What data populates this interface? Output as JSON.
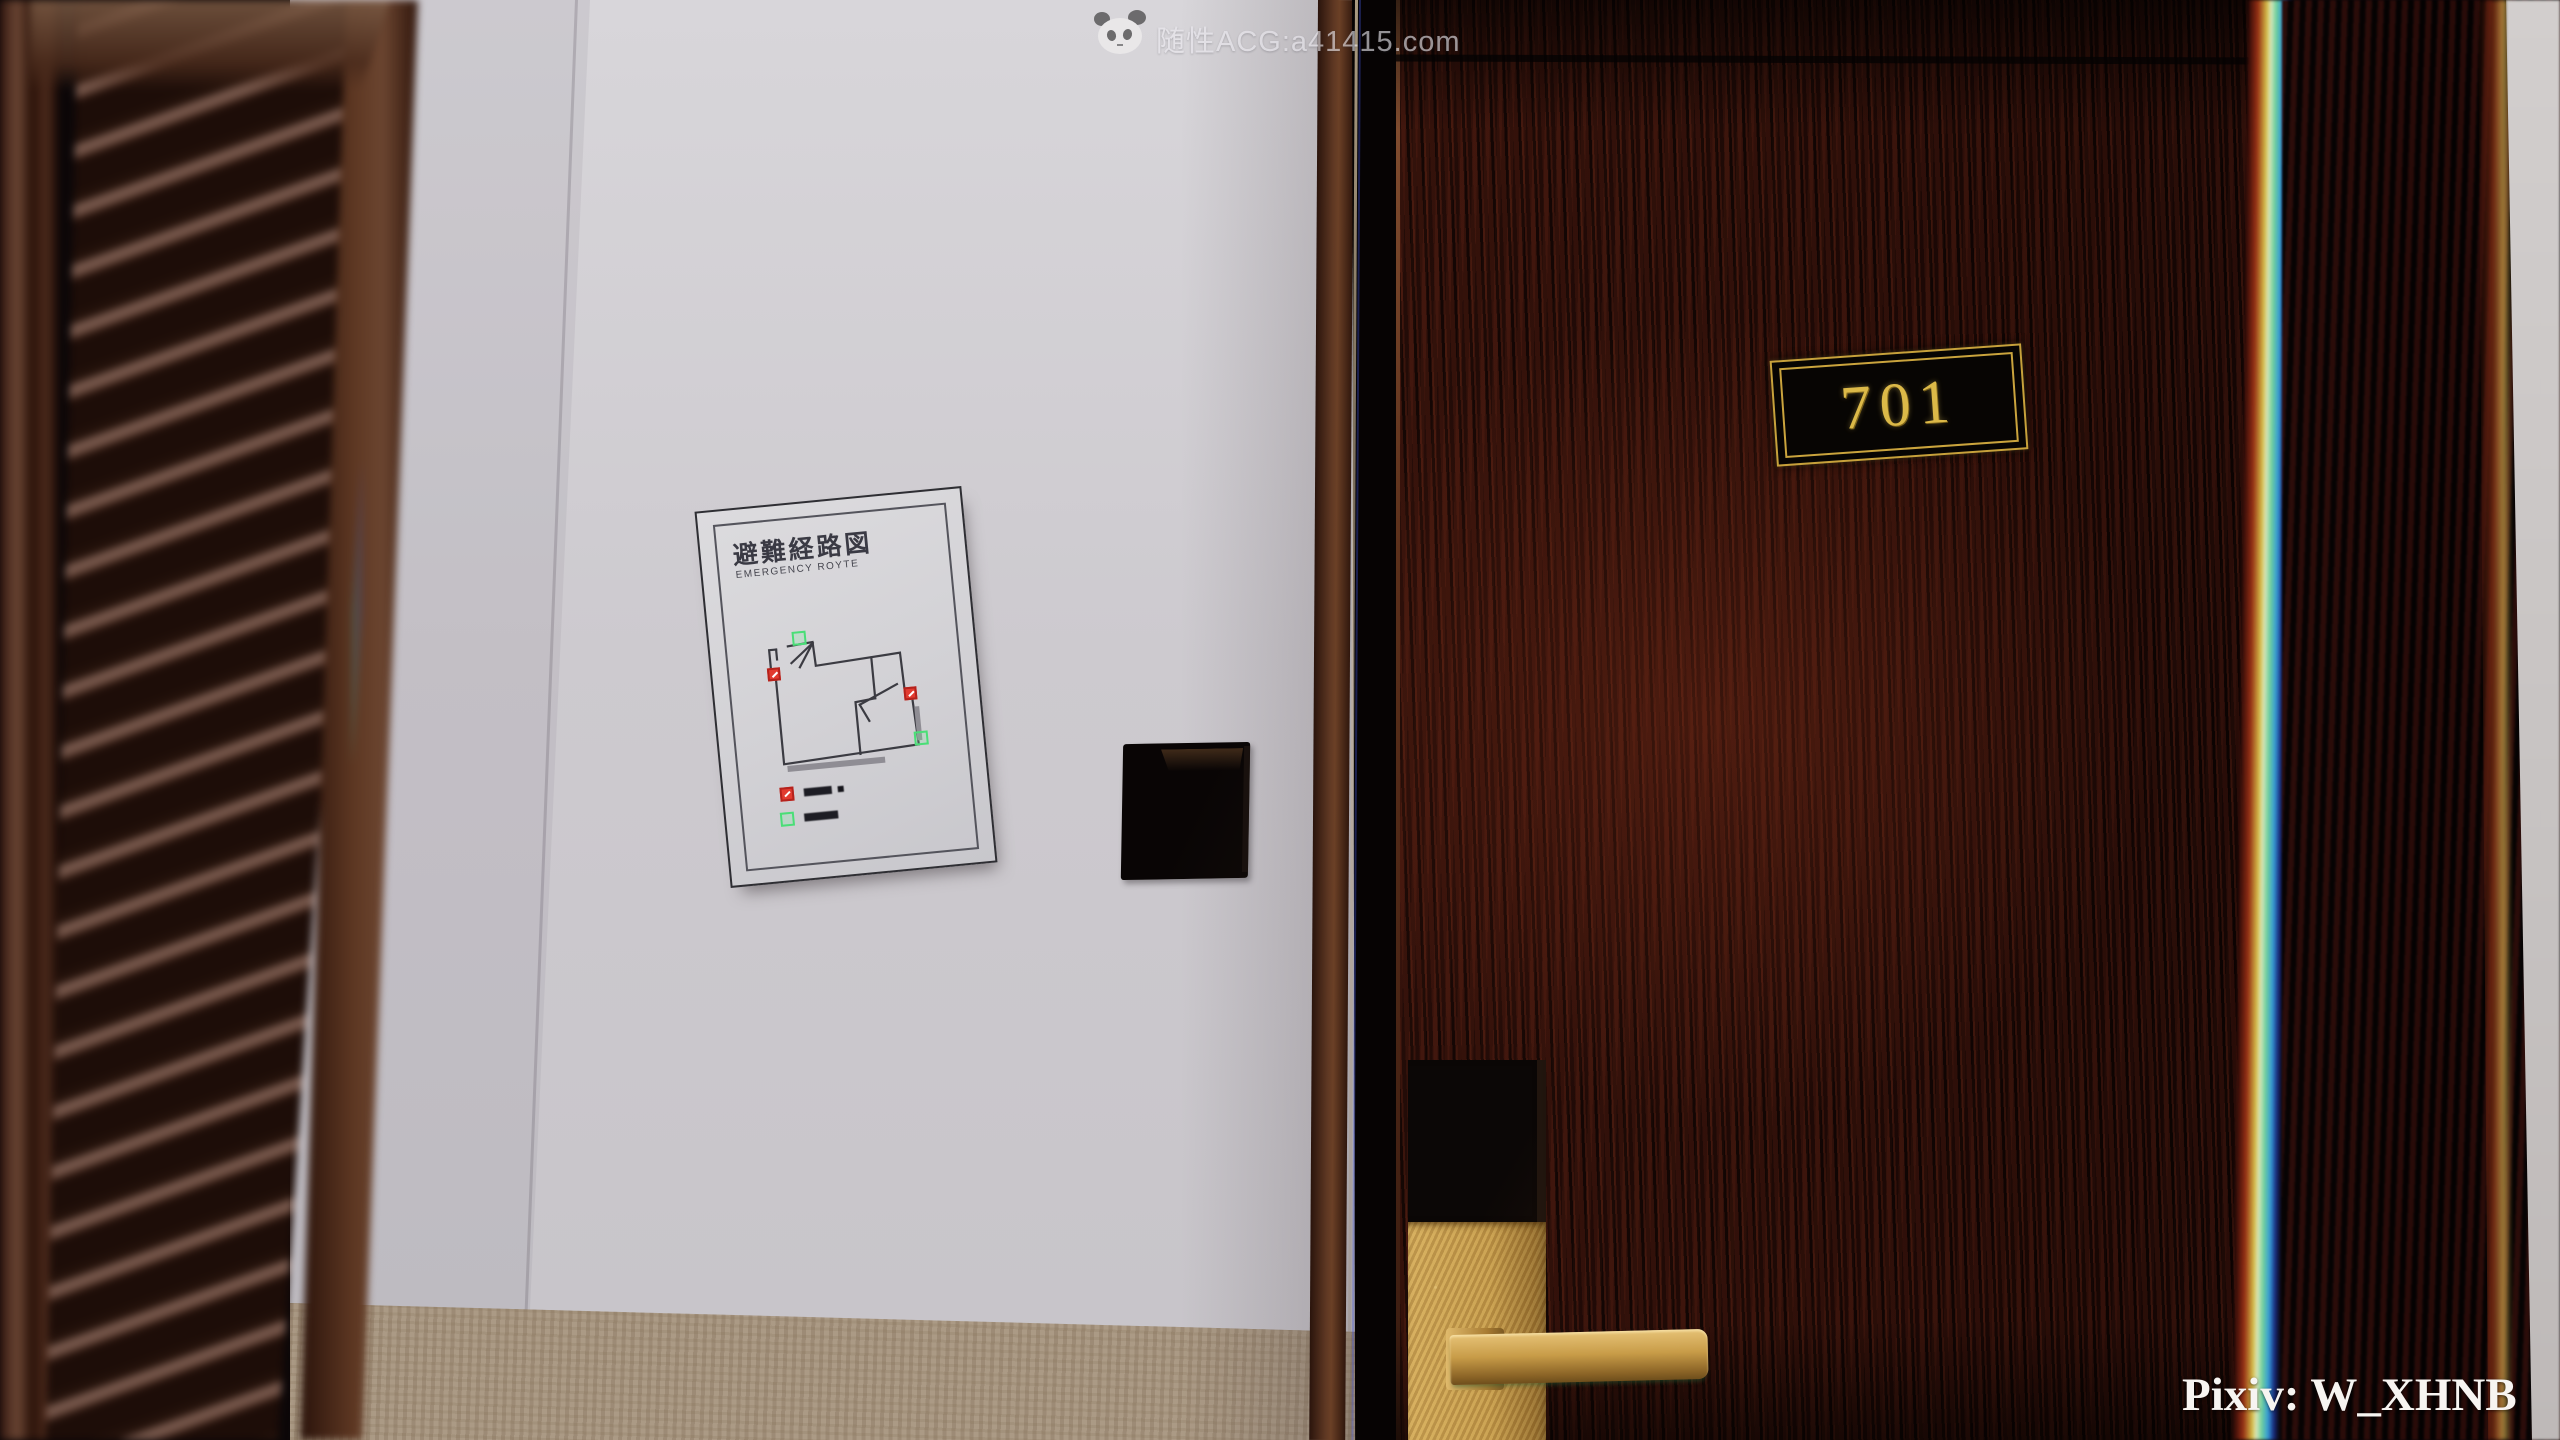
{
  "scene": {
    "description": "3D render of a hotel corridor: guest room door 701 beside an evacuation route sign"
  },
  "watermark_top": {
    "label": "随性ACG:a41415.com",
    "logo": "panda-logo"
  },
  "door": {
    "room_number": "701"
  },
  "evacuation_sign": {
    "title": "避難経路図",
    "subtitle": "EMERGENCY ROYTE",
    "marker_colors": {
      "exit_green": "#4ade77",
      "alarm_red": "#e23b30"
    }
  },
  "credit": {
    "pixiv": "Pixiv: W_XHNB"
  },
  "palette": {
    "door_wood": "#2f100a",
    "wall": "#cdcacf",
    "baseboard": "#ab9a85",
    "brass": "#c49a4c",
    "plate_gold": "#dcb948"
  }
}
